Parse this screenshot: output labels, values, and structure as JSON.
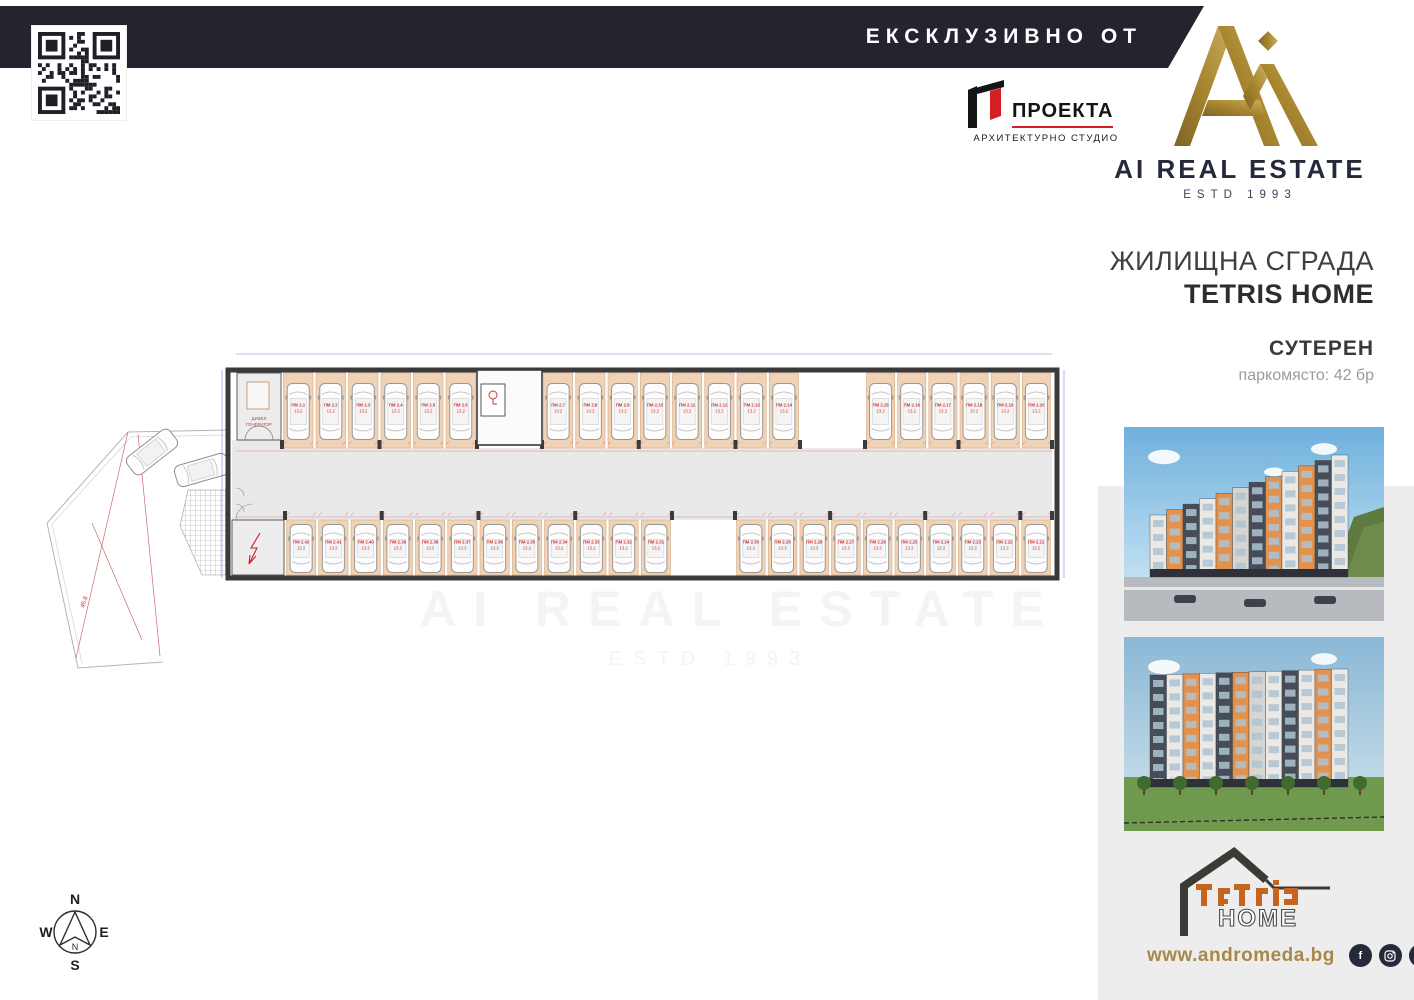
{
  "header": {
    "exclusive_label": "ЕКСКЛУЗИВНО ОТ",
    "bar_color": "#24242f"
  },
  "qr": {
    "name": "qr-code"
  },
  "architect": {
    "name": "ПРОЕКТА",
    "subtitle": "АРХИТЕКТУРНО СТУДИО",
    "accent": "#d21f26"
  },
  "brand": {
    "name": "AI REAL ESTATE",
    "estd": "ESTD 1993",
    "gold": "#a8862f",
    "navy": "#252a3a"
  },
  "project": {
    "building_type": "ЖИЛИЩНА СГРАДА",
    "name": "TETRIS HOME",
    "level": "СУТЕРЕН",
    "parking_info": "паркомясто: 42 бр"
  },
  "plan": {
    "title": "Г2  СУТЕРЕН - 42 ПМ",
    "entrance_a": "вход А",
    "entrance_b": "вход Б",
    "level_mark": "-3.40 = 152.15",
    "generator_room_line1": "ДИЗЕЛ",
    "generator_room_line2": "ГЕНЕРАТОР",
    "substation_line1": "АБОНАТНО",
    "substation_line2": "ТЕЦ",
    "water_meter": "ВОДОМЕР",
    "slope_label": "45.8",
    "default_area": "13.2",
    "top_row_spaces": [
      "ПМ 2.1",
      "ПМ 2.2",
      "ПМ 2.3",
      "ПМ 2.4",
      "ПМ 2.5",
      "ПМ 2.6",
      "ПМ 2.7",
      "ПМ 2.8",
      "ПМ 2.9",
      "ПМ 2.10",
      "ПМ 2.11",
      "ПМ 2.12",
      "ПМ 2.13",
      "ПМ 2.14",
      "ПМ 2.15",
      "ПМ 2.16",
      "ПМ 2.17",
      "ПМ 2.18",
      "ПМ 2.19",
      "ПМ 2.20"
    ],
    "bottom_row_spaces": [
      "ПМ 2.21",
      "ПМ 2.22",
      "ПМ 2.23",
      "ПМ 2.24",
      "ПМ 2.25",
      "ПМ 2.26",
      "ПМ 2.27",
      "ПМ 2.28",
      "ПМ 2.29",
      "ПМ 2.30",
      "ПМ 2.31",
      "ПМ 2.32",
      "ПМ 2.33",
      "ПМ 2.34",
      "ПМ 2.35",
      "ПМ 2.36",
      "ПМ 2.37",
      "ПМ 2.38",
      "ПМ 2.39",
      "ПМ 2.40",
      "ПМ 2.41",
      "ПМ 2.42"
    ],
    "colors": {
      "red": "#cc2129",
      "tan": "#f0d2b6",
      "aisle": "#e9e9e9",
      "wall": "#3a3a3a",
      "purple": "#8b3fc6",
      "violet_text": "#7b2fa3",
      "blue_text": "#4848c8"
    }
  },
  "compass": {
    "n": "N",
    "e": "E",
    "s": "S",
    "w": "W"
  },
  "sidebar": {
    "website": "www.andromeda.bg",
    "social": [
      "facebook",
      "instagram",
      "linkedin"
    ],
    "tetris_logo_text": "TETRIS",
    "tetris_logo_home": "HOME"
  },
  "watermark": {
    "line1": "AI REAL ESTATE",
    "line2": "ESTD 1993"
  }
}
